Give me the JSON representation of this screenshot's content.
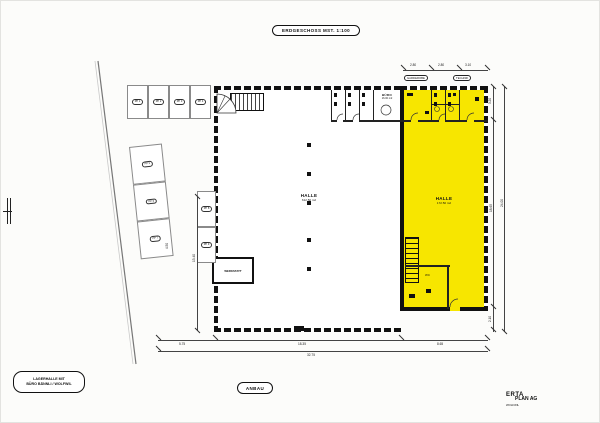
{
  "drawing": {
    "title": "ERDGESCHOSS MST. 1:100",
    "project_label": [
      "LAGERHALLE MIT",
      "BÜRO BÄNNLI / WOLFWIL"
    ],
    "anbau_label": "ANBAU",
    "logo": {
      "line1": "ERTA",
      "line2": "PLAN AG",
      "line3": "WOLFWIL"
    },
    "highlight_color": "#f7e600"
  },
  "rooms": {
    "hall_main": {
      "name": "HALLE",
      "area": "612.50 m2"
    },
    "hall_new": {
      "name": "HALLE",
      "area": "172.50 m2"
    },
    "werkstatt": {
      "name": "WERKSTATT"
    },
    "buero": {
      "name": "BÜRO",
      "area": "16.00 m2"
    },
    "garderobe": {
      "name": "GARDEROBE"
    },
    "technik": {
      "name": "TECHNIK"
    },
    "wc_new": {
      "name": "WC"
    }
  },
  "parking": {
    "top": [
      {
        "label": "PP 1"
      },
      {
        "label": "PP 2"
      },
      {
        "label": "PP 3"
      },
      {
        "label": "PP 4"
      }
    ],
    "road": [
      {
        "label": "PP 5"
      },
      {
        "label": "PP 6"
      },
      {
        "label": "PP 7"
      }
    ],
    "wall": [
      {
        "label": "PP 8"
      },
      {
        "label": "PP 9"
      }
    ]
  },
  "dimensions": {
    "top": [
      "2.80",
      "2.80",
      "3.10"
    ],
    "right": [
      "3.20",
      "18.65",
      "2.10"
    ],
    "right_total": "24.00",
    "bottom": [
      "5.75",
      "18.35",
      "8.65"
    ],
    "bottom_total": "32.75",
    "left_inner": "13.40",
    "left_small": "4.50"
  }
}
